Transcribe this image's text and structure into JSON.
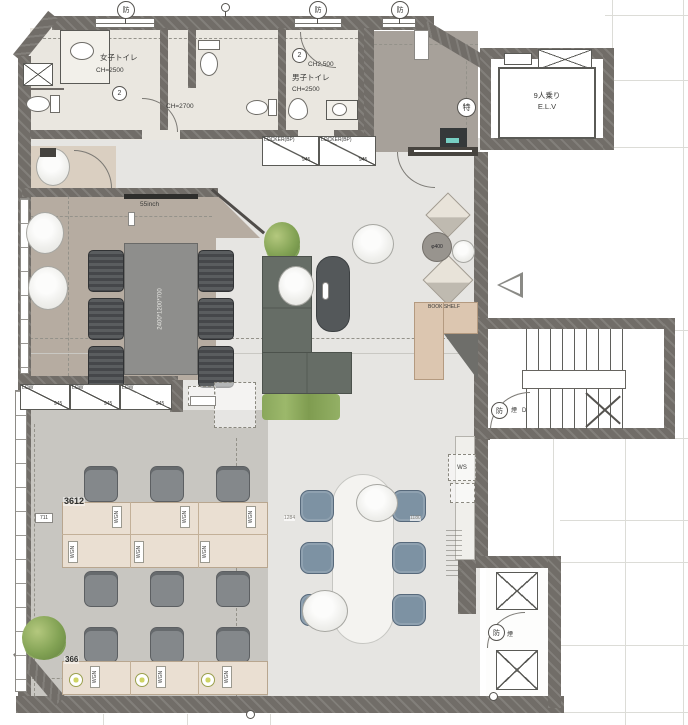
{
  "rooms": {
    "womens_toilet": {
      "name": "女子トイレ",
      "ch": "CH=2500",
      "mark": "2"
    },
    "mens_toilet": {
      "name": "男子トイレ",
      "ch_note": "CH2,500",
      "ch": "CH=2500",
      "mark": "2"
    },
    "hall": {
      "ch": "CH=2700"
    },
    "elevator": {
      "capacity": "9人乗り",
      "name": "E.L.V"
    }
  },
  "marks": {
    "fire": "防",
    "smoke": "煙",
    "special": "特",
    "door": "D"
  },
  "furniture": {
    "tv": "55inch",
    "meeting_table_size": "2400*1200*700",
    "locker": "LOCKER(BP)",
    "locker_width": "945",
    "low_cabinet": "LOW",
    "low_width": "945",
    "bookshelf": "BOOK SHELF",
    "round_table": "φ400",
    "desk_unit": "WGN",
    "workstation_sink": "WS"
  },
  "dims": {
    "desk_island": "3612",
    "desk_row": "366",
    "side": "711",
    "chair_left": "1284",
    "chair_right": "1180"
  }
}
